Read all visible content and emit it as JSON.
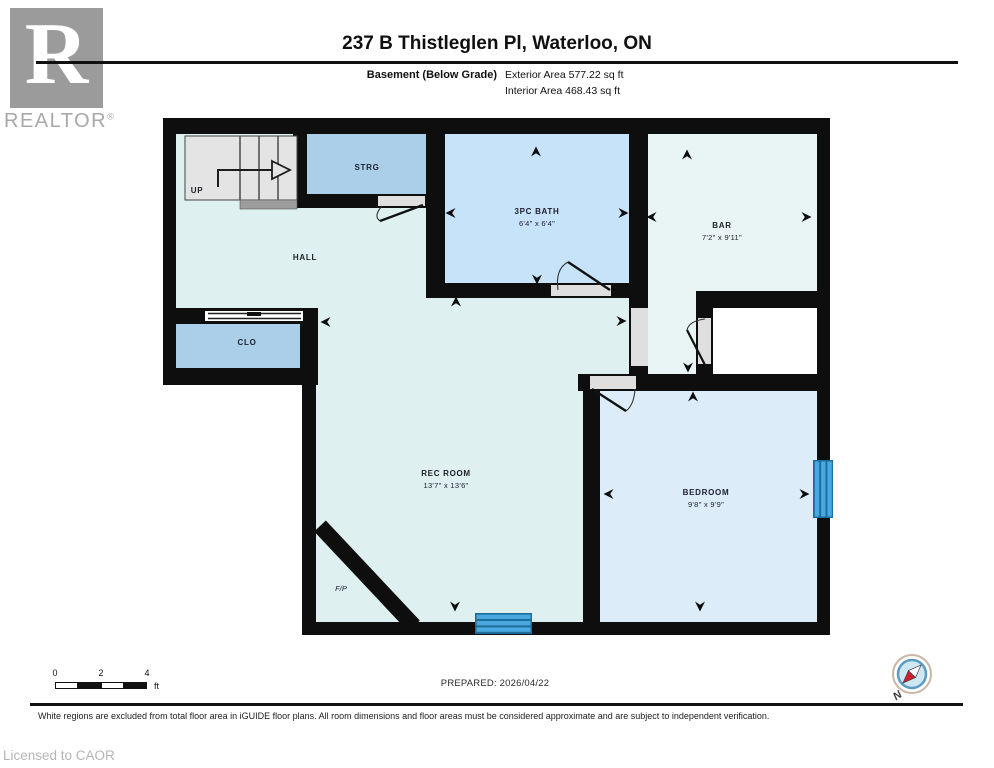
{
  "branding": {
    "logo_letter": "R",
    "logo_name": "REALTOR",
    "registered": "®",
    "licensed_to": "Licensed to CAOR"
  },
  "header": {
    "title": "237 B Thistleglen Pl, Waterloo, ON",
    "floor_label": "Basement (Below Grade)",
    "exterior_area": "Exterior Area 577.22 sq ft",
    "interior_area": "Interior Area 468.43 sq ft"
  },
  "rooms": {
    "up": {
      "label": "UP"
    },
    "strg": {
      "label": "STRG"
    },
    "hall": {
      "label": "HALL"
    },
    "clo": {
      "label": "CLO"
    },
    "bath": {
      "label": "3PC BATH",
      "dims": "6'4\" x 6'4\""
    },
    "bar": {
      "label": "BAR",
      "dims": "7'2\" x 9'11\""
    },
    "rec": {
      "label": "REC ROOM",
      "dims": "13'7\" x 13'6\""
    },
    "bed": {
      "label": "BEDROOM",
      "dims": "9'8\" x 9'9\""
    },
    "fireplace": {
      "label": "F/P"
    }
  },
  "scale_bar": {
    "tick0": "0",
    "tick2": "2",
    "tick4": "4",
    "unit": "ft"
  },
  "footer": {
    "prepared": "PREPARED: 2026/04/22",
    "disclaimer": "White regions are excluded from total floor area in iGUIDE floor plans. All room dimensions and floor areas must be considered approximate and are subject to independent verification.",
    "compass_north": "N"
  },
  "colors": {
    "wall": "#0e0e0e",
    "hall": "#def1f0",
    "bath": "#c6e3f9",
    "storage": "#abcfe9",
    "bar": "#e8f5f4",
    "bedroom": "#dcedf9",
    "whiteroom": "#ffffff",
    "winframe": "#1c6c9c",
    "winglass": "#4aa8e0",
    "stair": "#e4e4e4",
    "landing": "#9d9d9d",
    "doorgap": "#dfdfdf",
    "label": "#20202e",
    "logogray": "#9b9b9b",
    "textgray": "#a8a8a8"
  }
}
